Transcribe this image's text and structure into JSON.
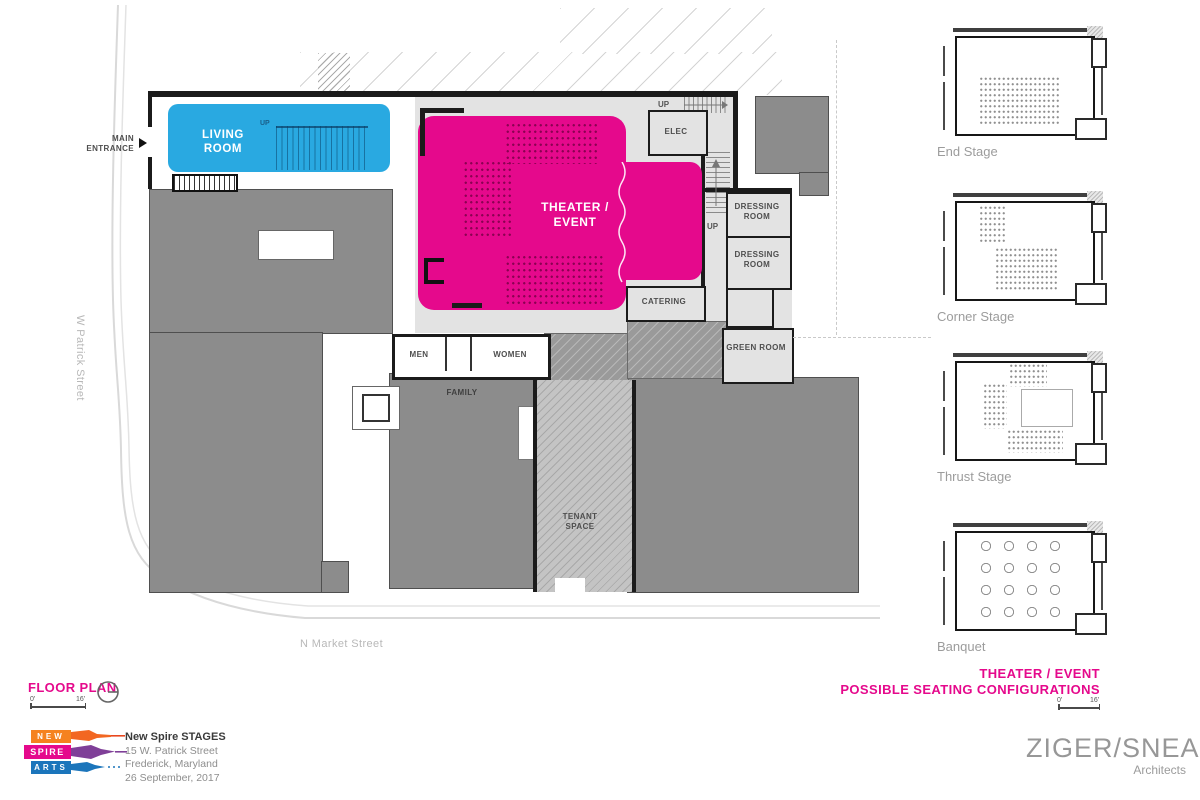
{
  "colors": {
    "accent_magenta": "#E5098C",
    "living_blue": "#29A9E1",
    "mass_gray": "#8C8C8C",
    "room_gray": "#E3E3E3",
    "wall_black": "#1B1B1B",
    "label_gray": "#9C9C9C",
    "street_gray": "#B8B8B8",
    "logo_orange": "#F5821F",
    "logo_purple": "#7F3F98",
    "logo_blue": "#1B75BB"
  },
  "plan": {
    "title": "FLOOR PLAN",
    "scale": {
      "start": "0'",
      "end": "16'"
    },
    "streets": {
      "west": "W Patrick Street",
      "south": "N Market Street"
    },
    "rooms": {
      "living_room": "LIVING ROOM",
      "theater_event": "THEATER / EVENT",
      "elec": "ELEC",
      "dressing_room_1": "DRESSING ROOM",
      "dressing_room_2": "DRESSING ROOM",
      "catering": "CATERING",
      "green_room": "GREEN ROOM",
      "men": "MEN",
      "women": "WOMEN",
      "family": "FAMILY",
      "tenant_space": "TENANT SPACE"
    },
    "annotations": {
      "main_entrance": "MAIN ENTRANCE",
      "up": "UP"
    }
  },
  "configurations": {
    "title_line1": "THEATER / EVENT",
    "title_line2": "POSSIBLE SEATING CONFIGURATIONS",
    "scale": {
      "start": "0'",
      "end": "16'"
    },
    "items": [
      {
        "label": "End Stage"
      },
      {
        "label": "Corner Stage"
      },
      {
        "label": "Thrust Stage"
      },
      {
        "label": "Banquet"
      }
    ]
  },
  "footer": {
    "logo_words": {
      "new": "NEW",
      "spire": "SPIRE",
      "arts": "ARTS"
    },
    "project": {
      "name": "New Spire STAGES",
      "address": "15 W. Patrick Street",
      "city": "Frederick, Maryland",
      "date": "26 September, 2017"
    },
    "firm": {
      "name": "ZIGER/SNEAD",
      "tagline": "Architects"
    }
  }
}
